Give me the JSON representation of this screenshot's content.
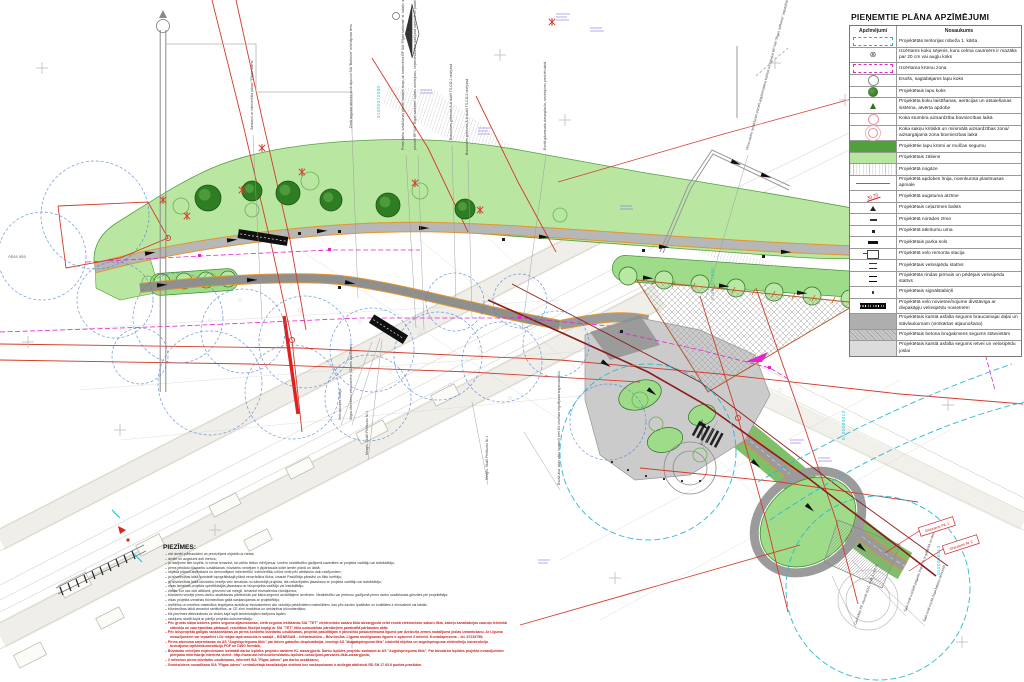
{
  "legend": {
    "title": "PIEŅEMTIE PLĀNA APZĪMĒJUMI",
    "columns": {
      "symbol": "Apzīmējumi",
      "name": "Nosaukums"
    },
    "rows": [
      {
        "sym": "boundary",
        "label": "Projektētās teritorijas robeža 1. kārta"
      },
      {
        "sym": "fell",
        "glyph": "⊗",
        "label": "Izcērtams koku sējenis, kura celma caurmērs ir mazāks par 20 cm vai augļu koks"
      },
      {
        "sym": "shrubzone",
        "label": "Izcērtama krūmu zona"
      },
      {
        "sym": "existtree",
        "label": "Esošs, saglabājams lapu koks"
      },
      {
        "sym": "projtree",
        "label": "Projektētais lapu koks"
      },
      {
        "sym": "watering",
        "label": "Projektēta koku laistīšanas, aerācijas un atsaiešanas sistēma, atvērta apdobe"
      },
      {
        "sym": "trunkprot",
        "label": "Koka stumbra aizsardzība būvniecības laikā"
      },
      {
        "sym": "rootzone",
        "label": "Koka sakņu kritiskā un minimālā aizsardzības zona/ aizsargājamā zona būvniecības laikā"
      },
      {
        "sym": "shrubs",
        "label": "Projektētie lapu krūmi ar mulčas segumu",
        "full": true
      },
      {
        "sym": "lawn",
        "label": "Projektētais zāliens",
        "full": true
      },
      {
        "sym": "slope",
        "label": "Projektētā nogāze",
        "full": true
      },
      {
        "sym": "curb",
        "label": "Projektētā apdobes līnija, noenkurota plastmasas apmale"
      },
      {
        "sym": "elev",
        "text": "30,70",
        "label": "Projektētā augstuma atzīme"
      },
      {
        "sym": "signpost",
        "label": "Projektētais ceļazīmes balsts"
      },
      {
        "sym": "roadsign",
        "label": "Projektētā norādes zīme"
      },
      {
        "sym": "urn",
        "label": "Projektētā atkritumu urna"
      },
      {
        "sym": "bench",
        "label": "Projektētais parka sols"
      },
      {
        "sym": "repair",
        "label": "Projektētā velo remonta stacija"
      },
      {
        "sym": "stand",
        "label": "Projektētais velosipēdu statīvs"
      },
      {
        "sym": "standfl",
        "label": "Projektētās rindas pirmais un pēdējais velosipēdu statīvs"
      },
      {
        "sym": "bollard",
        "label": "Projektētais signālstabiņš"
      },
      {
        "sym": "shelter",
        "label": "Projektētā velo novietne/nojume divstāvīga ar divpakāpju velosipēdu novietnēm"
      },
      {
        "sym": "asphdrive",
        "label": "Projektētais karstā asfalta segums braucamajai daļai un stāvlaukumam (virskārtas atjaunošana)",
        "full": true
      },
      {
        "sym": "paver",
        "label": "Projektētais betona bruģakmens segums stāvvietām",
        "full": true
      },
      {
        "sym": "asphpath",
        "label": "Projektētais karstā asfalta segums ietvei un velosipēdu joslai",
        "full": true
      }
    ]
  },
  "notes": {
    "heading": "PIEZĪMES:",
    "lines": [
      {
        "color": "black",
        "text": "visi izmēri pārbaudāmi un precizējami objektā uz vietas;"
      },
      {
        "color": "black",
        "text": "izmēri un augstumi doti metros;"
      },
      {
        "color": "black",
        "text": "ja rasējums tiek kopēts, to nevar izmantot, lai veiktu tiešus mērījumus. Izmēru neatbilstību gadījumā sazināties ar projekta vadītāju vai izstrādātāju;"
      },
      {
        "color": "black",
        "text": "pirms jebkādu būvdarbu uzsākšanas, būvdarbu veicējam ir jāpārbauda dotie izmēri plānā un dabā;"
      },
      {
        "color": "black",
        "text": "objektā plānoti atslēdzami un demontējami inženiertīkli. Inženiertīklu izbūvi veikt pēc atbilstošo daļu rasējumiem;"
      },
      {
        "color": "black",
        "text": "ja būvniecības laikā konstatē topogrāfiskajā plānā neuzrādītus tīklus, izsaukt Pasūtītāja pārstāvi un tīklu turētāju;"
      },
      {
        "color": "black",
        "text": "ja būvniecības laikā būvdarbu veicējs veic izmaiņas no sākotnējā projekta, tās nekavējoties jāsaskaņo ar projekta vadītāju vai izstrādātāju;"
      },
      {
        "color": "black",
        "text": "visas izmaiņas projekta specifikācijās jāsaskaņo ar būvprojekta vadītāju vai izstrādātāju;"
      },
      {
        "color": "black",
        "text": "vietās, kur nav doti attālumi, griezumi vai mezgli, izmantot ekvivalentus risinājumus;"
      },
      {
        "color": "black",
        "text": "būvdarbu veicējs pirms darbu uzsākšanas pārliecinās par katra seguma uzrādītajiem izmēriem. Neatbilstību vai pretrunu gadījumā pirms darbu uzsākšanas griezties pie projektētāja;"
      },
      {
        "color": "black",
        "text": "visas projekta izmaiņas būvniecības gaitā saskaņojamas ar projektētāju;"
      },
      {
        "color": "black",
        "text": "izvēlētos un minētos materiālus iespējams aizstāt ar ekvivalentiem citu ražotāju piedāvātiem materiāliem, kas pēc savām īpašībām un kvalitātes ir ekvivalenti vai labāki;"
      },
      {
        "color": "black",
        "text": "būvniecības laikā izmantot sertificētus, ar CE zīmi marķētus un deklarētus būvmateriālus;"
      },
      {
        "color": "black",
        "text": "šīs piezīmes attiecināmas uz visām šajā lapā izmantotajām rasējuma lapām;"
      },
      {
        "color": "black",
        "text": "rasējumu skatīt kopā ar pārējo projekta dokumentāciju;"
      },
      {
        "color": "red",
        "text": "Pēc grunts slāņa izbūves pirms seguma atjaunošanas, cietā seguma ieklāšanas SIA \"TET\" elektronisko sakaru tīkla aizsargjoslā veikt esošā elektronisko sakaru tīkla, kabeļu kanalizācijas cauruļu tehniskā stāvokļa un caurejamības pārbaudi, rezultātus fiksējot kopīgi ar SIA \"TET\" tīkla uzraudzības pārstāvjiem parakstītā pārbaudes aktā;"
      },
      {
        "color": "red",
        "text": "Pēc būvprojekta galīgās saskaņošanas un pirms konkrēto būvdarbu uzsākšanas, projekta pasūtītājam ir jānoslēdz pašaizņēmuma līgums par dzelzceļa zemes nodalījuma joslas izmantošanu. Ar Līguma nosacījumiem var iepazīties LDz mājas lapā www.ldz.lv sadaļā – BIZNESAM – Infrastruktūra – Būvniecība. Līguma noslēgšanas ilgums ir aptuveni 2 mēneši. Kontaktpersona – tel. 67233758;"
      },
      {
        "color": "red",
        "text": "Pirms atzinuma saņemšanas no AS \"Augstsprieguma tīkls\" par būves gatavību ekspluatācijai, iesniegt AS \"Augstsprieguma tīkls\" izbūvētā objekta un augstsprieguma elektrolīniju konstrukciju tuvinājuma izpilddokumentāciju PDF un DWG formātā;"
      },
      {
        "color": "red",
        "text": "Būvdarbu veicējam nepieciešams izstrādāt darbu izpildes projektu darbiem KL aizsargjoslā. Darbu izpildes projektu saskaņot ar AS \"Augstsprieguma tīkls\". Par būvdarbu izpildes projekta nosacījumiem pieejama informācija interneta vietnē: http://www.ast.lv/lv/content/darbu-izpildes-nosacijumi-parvades-tikla-aizsargjosla;"
      },
      {
        "color": "red",
        "text": "3 mēnešus pirms būvdarbu uzsākšanas, informēt SIA \"Rīgas ūdens\" par darbu uzsākšanu;"
      },
      {
        "color": "red",
        "text": "Gruntsūdens novadīšana SIA \"Rīgas ūdens\" centralizētajā kanalizācijas sistēmā bez saskaņošanas ir aizliegta atbilstoši RD SN 17 63.6 punkta prasībām."
      }
    ]
  },
  "plan": {
    "street_labels": [
      {
        "t": "Akas iela",
        "x": 8,
        "y": 258
      }
    ],
    "callouts": [
      {
        "t": "Saskaņot ar inženiertīkla pārzini \"Rīgas ūdens\"",
        "x": 253,
        "y": 130,
        "r": -90
      },
      {
        "t": "Cietā seguma izbūves zonā atjaunot SIA \"Balticom\" brīdinājuma lentu",
        "x": 352,
        "y": 128,
        "r": -90
      },
      {
        "t": "Pirms darbu uzsākšanas pārcelt sadales skapi, lai kombinētos RP SIA \"Rīgas satiksme\" el. kabeļu izbūvei",
        "x": 404,
        "y": 150,
        "r": -90
      },
      {
        "t": "precizēt RP SIA \"Rīgas satiksme\" kabeļu izvietojumu, nepieciešamības gadījumā pārbūvēt un padziļināt līdz 1 m dziļumam",
        "x": 416,
        "y": 150,
        "r": -90
      },
      {
        "t": "Brauktuves griezums A-A skatīt TS-CO-1 rasējumā",
        "x": 452,
        "y": 140,
        "r": -90
      },
      {
        "t": "Brauktuves griezums A-A skatīt TS-CO-3 rasējumā",
        "x": 468,
        "y": 155,
        "r": -90
      },
      {
        "t": "Esošā gāzesvada aizsargčaula, novietojumu precizēt dabā",
        "x": 546,
        "y": 150,
        "r": -90
      },
      {
        "t": "Pirms darbu uzsākšanas pārcelt apgaismojuma balstus un kabeļus RP SIA \"Rīgas satiksme\" vajadzībām",
        "x": 748,
        "y": 150,
        "r": -75
      },
      {
        "t": "Mezgls. Skatīt Pielikumu Nr.1",
        "x": 368,
        "y": 455,
        "r": -90
      },
      {
        "t": "Mezgls. Skatīt Pielikumu Nr.1",
        "x": 488,
        "y": 480,
        "r": -90
      },
      {
        "t": "Segta divvirzienu velonovietne (32 velo stāvvietas)",
        "x": 352,
        "y": 420,
        "r": -90
      },
      {
        "t": "Velo apkopes stacija",
        "x": 341,
        "y": 420,
        "r": -90
      },
      {
        "t": "Esošā aka, akas vāku nomainīt pret 40t izturības regulējama augstuma lūku",
        "x": 560,
        "y": 485,
        "r": -90
      },
      {
        "t": "Griezums A-B1-1",
        "x": 703,
        "y": 445,
        "r": -90
      },
      {
        "t": "Šajā zonā uzstādīt pagaidu žogu 7,5 m gabarītā no sliežu ass",
        "x": 906,
        "y": 612,
        "r": -70
      },
      {
        "t": "Šajā zonā esošā žoga balstus demontēt",
        "x": 925,
        "y": 622,
        "r": -70
      },
      {
        "t": "Caurtekas PE caurule d110, SN8, L=5,0 m",
        "x": 856,
        "y": 625,
        "r": -70
      }
    ],
    "parcel_numbers": [
      {
        "t": "01000372080",
        "x": 380,
        "y": 118
      },
      {
        "t": "01000372080",
        "x": 714,
        "y": 300
      },
      {
        "t": "0100000013",
        "x": 845,
        "y": 440
      },
      {
        "t": "0100000013",
        "x": 940,
        "y": 575
      }
    ],
    "section_labels": [
      {
        "t": "Grieziens PK 1",
        "x": 937,
        "y": 527,
        "r": -18
      },
      {
        "t": "Grieziens Nr 2",
        "x": 961,
        "y": 545,
        "r": -18
      }
    ]
  },
  "trees": {
    "canopies": [
      [
        208,
        198,
        13
      ],
      [
        252,
        191,
        10
      ],
      [
        288,
        193,
        12
      ],
      [
        331,
        200,
        11
      ],
      [
        388,
        205,
        12
      ],
      [
        465,
        209,
        10
      ]
    ],
    "existing": [
      [
        181,
        206,
        8
      ],
      [
        310,
        181,
        9
      ],
      [
        420,
        191,
        8
      ],
      [
        252,
        210,
        7
      ],
      [
        560,
        215,
        7
      ],
      [
        640,
        400,
        8
      ],
      [
        656,
        424,
        7
      ],
      [
        700,
        455,
        7
      ],
      [
        148,
        282,
        6
      ],
      [
        210,
        279,
        6
      ]
    ],
    "protection_circles": [
      [
        115,
        300,
        38
      ],
      [
        178,
        318,
        45
      ],
      [
        243,
        331,
        42
      ],
      [
        305,
        342,
        46
      ],
      [
        372,
        350,
        42
      ],
      [
        438,
        356,
        44
      ],
      [
        502,
        362,
        40
      ],
      [
        556,
        344,
        33
      ],
      [
        210,
        383,
        52
      ],
      [
        292,
        392,
        47
      ],
      [
        368,
        398,
        43
      ],
      [
        140,
        356,
        28
      ],
      [
        455,
        302,
        29
      ],
      [
        520,
        301,
        27
      ],
      [
        95,
        215,
        54
      ],
      [
        42,
        256,
        44
      ],
      [
        608,
        422,
        38
      ]
    ],
    "clearance_circles": [
      [
        648,
        452,
        88
      ],
      [
        878,
        588,
        92
      ]
    ]
  },
  "colors": {
    "lawn": "#b9e7a2",
    "shrubs": "#51a03e",
    "path_edge_orange": "#c75b12",
    "asphalt": "#b0b0b0",
    "utility_red": "#d43a2a",
    "magenta": "#e226c8",
    "cyan_parcel": "#27c4d8",
    "blue_protection": "#4a7fd4",
    "axis_dark_red": "#8b1a1a"
  }
}
